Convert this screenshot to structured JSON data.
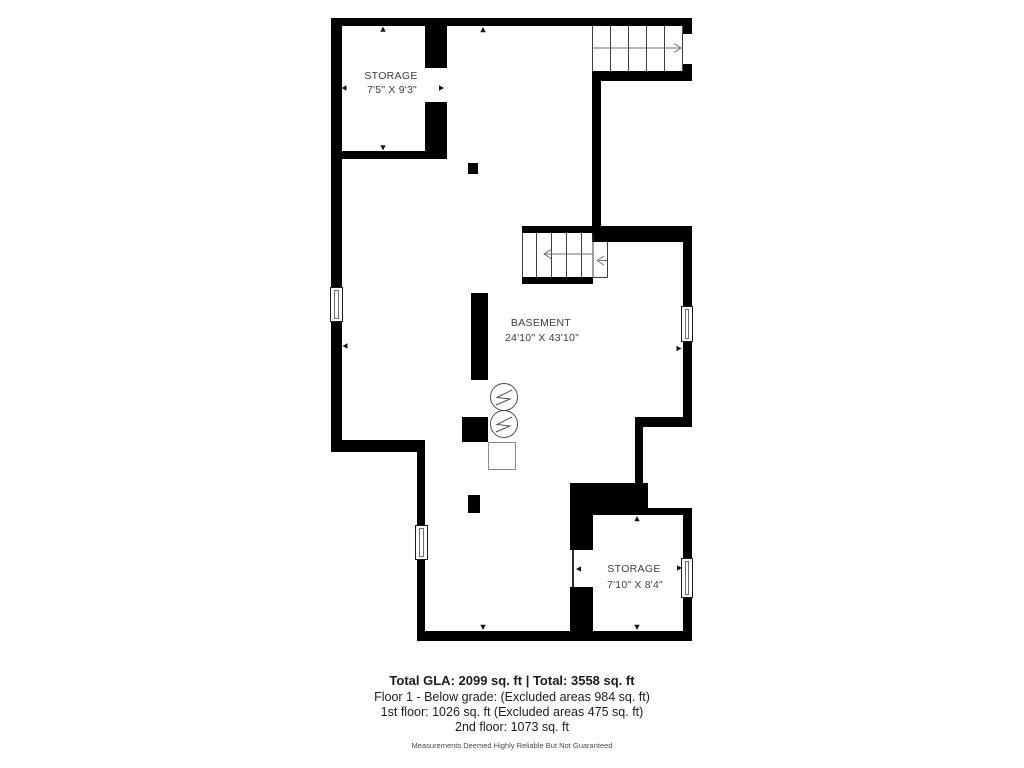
{
  "plan": {
    "rooms": [
      {
        "id": "storage-upper",
        "name": "STORAGE",
        "dims": "7'5\" X 9'3\""
      },
      {
        "id": "basement",
        "name": "BASEMENT",
        "dims": "24'10\" X 43'10\""
      },
      {
        "id": "storage-lower",
        "name": "STORAGE",
        "dims": "7'10\" X 8'4\""
      }
    ]
  },
  "footer": {
    "totals": "Total GLA: 2099 sq. ft | Total: 3558 sq. ft",
    "floor1": "Floor 1 - Below grade: (Excluded areas 984 sq. ft)",
    "first_floor": "1st floor: 1026 sq. ft (Excluded areas 475 sq. ft)",
    "second_floor": "2nd floor: 1073 sq. ft",
    "disclaimer": "Measurements Deemed Highly Reliable But Not Guaranteed"
  },
  "colors": {
    "wall": "#000000",
    "background": "#ffffff",
    "label_text": "#3d3d3d",
    "stair_line": "#3f3f3f",
    "arrow_line": "#6e6e6e"
  }
}
